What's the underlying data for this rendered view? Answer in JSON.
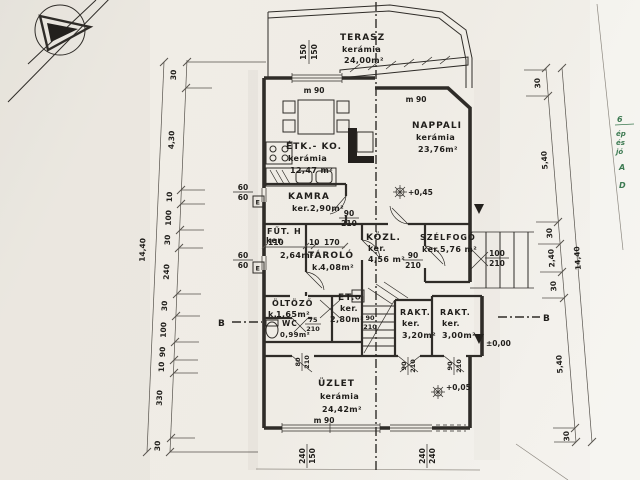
{
  "document": {
    "kind": "scanned architectural floor plan"
  },
  "rooms": {
    "terasz": {
      "name": "TERASZ",
      "finish": "kerámia",
      "area": "24,00m²"
    },
    "etk_ko": {
      "name": "ÉTK.- KO.",
      "finish": "kerámia",
      "area": "12,47 m²"
    },
    "nappali": {
      "name": "NAPPALI",
      "finish": "kerámia",
      "area": "23,76m²"
    },
    "kamra": {
      "name": "KAMRA",
      "finish": "ker.",
      "area": "2,90m²"
    },
    "fut_h": {
      "name": "FŰT. H",
      "finish": "ker.",
      "area": "2,64m²"
    },
    "tarolo": {
      "name": "TÁROLÓ",
      "finish": "k.",
      "area": "4,08m²"
    },
    "kozl": {
      "name": "KÖZL.",
      "finish": "ker.",
      "area": "4,56 m²"
    },
    "szelfogo": {
      "name": "SZÉLFOGÓ",
      "finish": "ker.",
      "area": "5,76 m²"
    },
    "oltozo": {
      "name": "ÖLTÖZŐ",
      "finish": "k.",
      "area": "1,65m²"
    },
    "et": {
      "name": "ET.",
      "finish": "ker.",
      "area": "2,80m²"
    },
    "wc": {
      "name": "WC",
      "area": "0,99m²"
    },
    "rakt1": {
      "name": "RAKT.",
      "finish": "ker.",
      "area": "3,20m²"
    },
    "rakt2": {
      "name": "RAKT.",
      "finish": "ker.",
      "area": "3,00m²"
    },
    "uzlet": {
      "name": "ÜZLET",
      "finish": "kerámia",
      "area": "24,42m²"
    }
  },
  "levels": {
    "nappali": "+0,45",
    "uzlet": "+0,05",
    "rakt": "±0,00"
  },
  "section": {
    "left": "B",
    "right": "B"
  },
  "wall_labels": {
    "m90": "m 90"
  },
  "fixtures": {
    "electric_box": "E",
    "boiler": "O"
  },
  "dims": {
    "left_chain": [
      "30",
      "4,30",
      "10",
      "100",
      "30",
      "240",
      "30",
      "100",
      "90",
      "10",
      "330",
      "30"
    ],
    "left_total": "14,40",
    "right_chain": [
      "30",
      "5,40",
      "30",
      "2,40",
      "30",
      "5,40",
      "30"
    ],
    "right_total": "14,40",
    "fut_segments": [
      "110",
      "10",
      "170"
    ],
    "fractions": {
      "top_window": {
        "a": "150",
        "b": "150"
      },
      "kitchen_win_upper": {
        "a": "60",
        "b": "60"
      },
      "kitchen_win_lower": {
        "a": "60",
        "b": "60"
      },
      "kamra_door": {
        "a": "90",
        "b": "210"
      },
      "kozl_door": {
        "a": "90",
        "b": "210"
      },
      "szelfogo_door": {
        "a": "100",
        "b": "210"
      },
      "wc_door": {
        "a": "75",
        "b": "210"
      },
      "stair_door": {
        "a": "90",
        "b": "210"
      },
      "oltozo_door": {
        "a": "80",
        "b": "210"
      },
      "rakt1_door": {
        "a": "90",
        "b": "210"
      },
      "rakt2_door": {
        "a": "90",
        "b": "210"
      },
      "bottom_window": {
        "a": "240",
        "b": "150"
      },
      "bottom_door": {
        "a": "240",
        "b": "240"
      }
    }
  },
  "handwriting": {
    "lines": [
      "6",
      "ép",
      "és",
      "jó",
      "A",
      "D"
    ]
  }
}
